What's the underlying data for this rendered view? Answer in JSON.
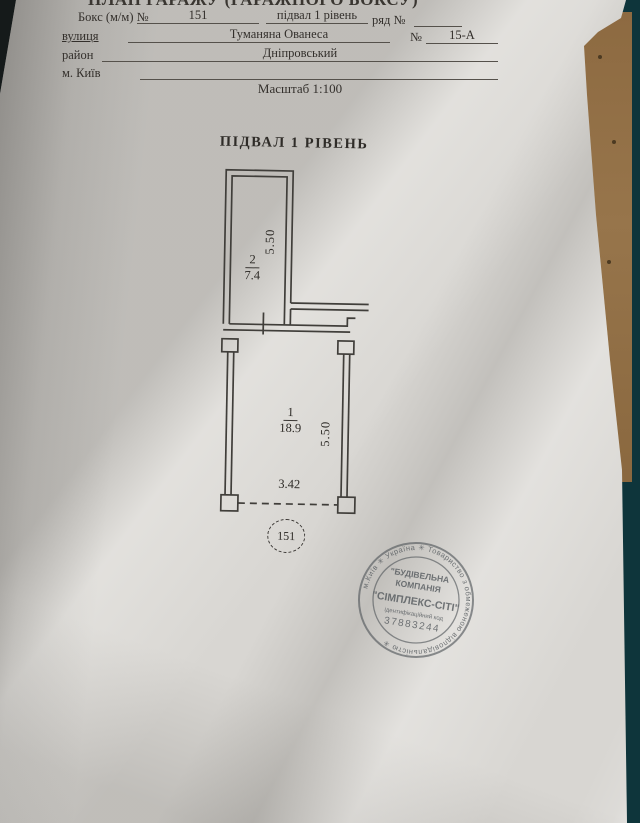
{
  "photo": {
    "background_color": "#0e353b",
    "table_strip_color": "#8d6a41",
    "paper_color": "#d8d6d2",
    "line_color": "#403e3a",
    "stamp_ink_color": "#565b5f"
  },
  "header": {
    "title": "ПЛАН ГАРАЖУ (ГАРАЖНОГО БОКСУ)"
  },
  "form": {
    "row1": {
      "label": "Бокс (м/м) №",
      "box_number": "151",
      "level": "підвал 1 рівень",
      "row_label": "ряд №",
      "row_value": ""
    },
    "row2": {
      "label": "вулиця",
      "street": "Туманяна Ованеса",
      "number_label": "№",
      "building": "15-А"
    },
    "row3": {
      "label": "район",
      "district": "Дніпровський"
    },
    "row4": {
      "label": "м. Київ"
    }
  },
  "scale_label": "Масштаб 1:100",
  "plan": {
    "title": "ПІДВАЛ 1 РІВЕНЬ",
    "room2": {
      "number": "2",
      "area": "7.4",
      "depth": "5.50"
    },
    "room1": {
      "number": "1",
      "area": "18.9",
      "depth": "5.50",
      "width": "3.42"
    },
    "box_label": "151"
  },
  "stamp": {
    "ring_text": "м.Київ ✳ Україна ✳ Товариство з обмеженою відповідальністю ✳",
    "line1": "\"БУДІВЕЛЬНА",
    "line2": "КОМПАНІЯ",
    "line3": "\"СІМПЛЕКС-СІТІ\"",
    "line4": "ідентифікаційний код",
    "line5": "37883244"
  }
}
